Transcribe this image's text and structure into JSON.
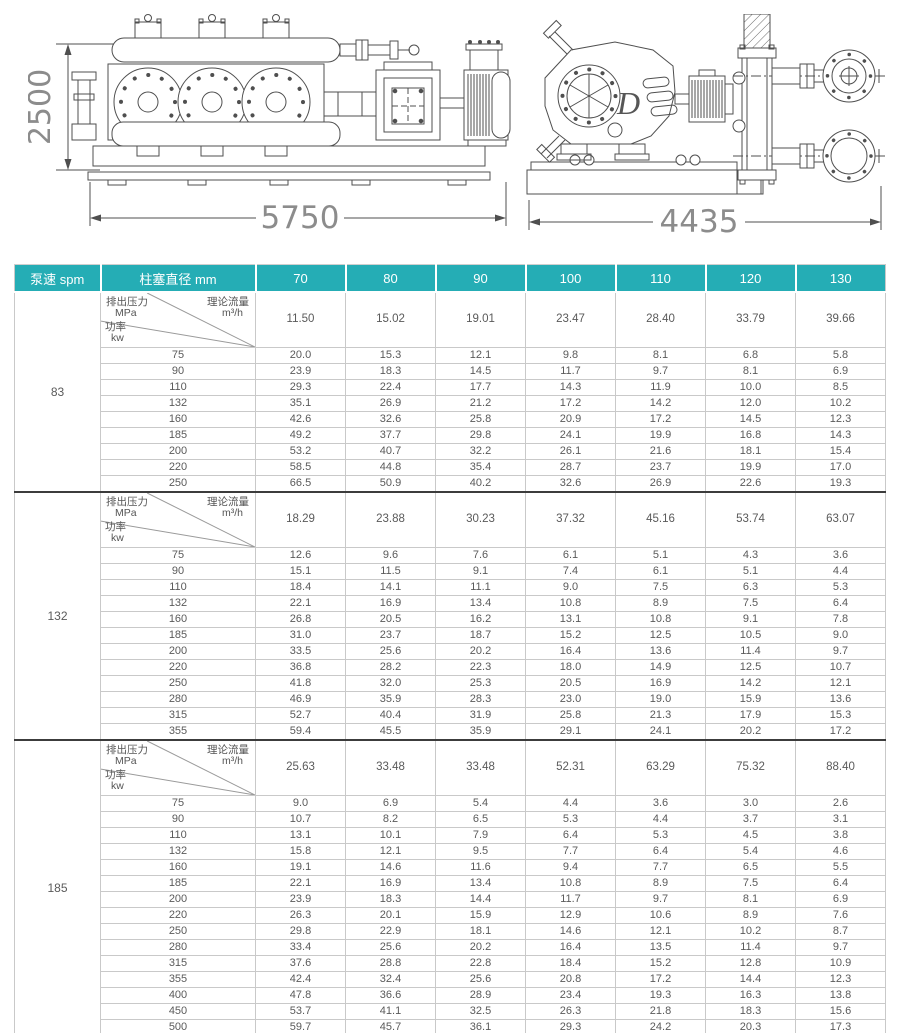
{
  "drawings": {
    "side_view": {
      "height_dim": "2500",
      "length_dim": "5750"
    },
    "end_view": {
      "length_dim": "4435"
    }
  },
  "table": {
    "accent_color": "#25adb5",
    "header": {
      "speed_label": "泵速 spm",
      "diameter_label": "柱塞直径 mm",
      "diameters": [
        "70",
        "80",
        "90",
        "100",
        "110",
        "120",
        "130"
      ]
    },
    "corner": {
      "pressure_label": "排出压力",
      "pressure_unit": "MPa",
      "flow_label": "理论流量",
      "flow_unit": "m³/h",
      "power_label": "功率",
      "power_unit": "kw"
    },
    "sections": [
      {
        "speed": "83",
        "flow": [
          "11.50",
          "15.02",
          "19.01",
          "23.47",
          "28.40",
          "33.79",
          "39.66"
        ],
        "rows": [
          {
            "pressure": "75",
            "values": [
              "20.0",
              "15.3",
              "12.1",
              "9.8",
              "8.1",
              "6.8",
              "5.8"
            ]
          },
          {
            "pressure": "90",
            "values": [
              "23.9",
              "18.3",
              "14.5",
              "11.7",
              "9.7",
              "8.1",
              "6.9"
            ]
          },
          {
            "pressure": "110",
            "values": [
              "29.3",
              "22.4",
              "17.7",
              "14.3",
              "11.9",
              "10.0",
              "8.5"
            ]
          },
          {
            "pressure": "132",
            "values": [
              "35.1",
              "26.9",
              "21.2",
              "17.2",
              "14.2",
              "12.0",
              "10.2"
            ]
          },
          {
            "pressure": "160",
            "values": [
              "42.6",
              "32.6",
              "25.8",
              "20.9",
              "17.2",
              "14.5",
              "12.3"
            ]
          },
          {
            "pressure": "185",
            "values": [
              "49.2",
              "37.7",
              "29.8",
              "24.1",
              "19.9",
              "16.8",
              "14.3"
            ]
          },
          {
            "pressure": "200",
            "values": [
              "53.2",
              "40.7",
              "32.2",
              "26.1",
              "21.6",
              "18.1",
              "15.4"
            ]
          },
          {
            "pressure": "220",
            "values": [
              "58.5",
              "44.8",
              "35.4",
              "28.7",
              "23.7",
              "19.9",
              "17.0"
            ]
          },
          {
            "pressure": "250",
            "values": [
              "66.5",
              "50.9",
              "40.2",
              "32.6",
              "26.9",
              "22.6",
              "19.3"
            ]
          }
        ]
      },
      {
        "speed": "132",
        "flow": [
          "18.29",
          "23.88",
          "30.23",
          "37.32",
          "45.16",
          "53.74",
          "63.07"
        ],
        "rows": [
          {
            "pressure": "75",
            "values": [
              "12.6",
              "9.6",
              "7.6",
              "6.1",
              "5.1",
              "4.3",
              "3.6"
            ]
          },
          {
            "pressure": "90",
            "values": [
              "15.1",
              "11.5",
              "9.1",
              "7.4",
              "6.1",
              "5.1",
              "4.4"
            ]
          },
          {
            "pressure": "110",
            "values": [
              "18.4",
              "14.1",
              "11.1",
              "9.0",
              "7.5",
              "6.3",
              "5.3"
            ]
          },
          {
            "pressure": "132",
            "values": [
              "22.1",
              "16.9",
              "13.4",
              "10.8",
              "8.9",
              "7.5",
              "6.4"
            ]
          },
          {
            "pressure": "160",
            "values": [
              "26.8",
              "20.5",
              "16.2",
              "13.1",
              "10.8",
              "9.1",
              "7.8"
            ]
          },
          {
            "pressure": "185",
            "values": [
              "31.0",
              "23.7",
              "18.7",
              "15.2",
              "12.5",
              "10.5",
              "9.0"
            ]
          },
          {
            "pressure": "200",
            "values": [
              "33.5",
              "25.6",
              "20.2",
              "16.4",
              "13.6",
              "11.4",
              "9.7"
            ]
          },
          {
            "pressure": "220",
            "values": [
              "36.8",
              "28.2",
              "22.3",
              "18.0",
              "14.9",
              "12.5",
              "10.7"
            ]
          },
          {
            "pressure": "250",
            "values": [
              "41.8",
              "32.0",
              "25.3",
              "20.5",
              "16.9",
              "14.2",
              "12.1"
            ]
          },
          {
            "pressure": "280",
            "values": [
              "46.9",
              "35.9",
              "28.3",
              "23.0",
              "19.0",
              "15.9",
              "13.6"
            ]
          },
          {
            "pressure": "315",
            "values": [
              "52.7",
              "40.4",
              "31.9",
              "25.8",
              "21.3",
              "17.9",
              "15.3"
            ]
          },
          {
            "pressure": "355",
            "values": [
              "59.4",
              "45.5",
              "35.9",
              "29.1",
              "24.1",
              "20.2",
              "17.2"
            ]
          }
        ]
      },
      {
        "speed": "185",
        "flow": [
          "25.63",
          "33.48",
          "33.48",
          "52.31",
          "63.29",
          "75.32",
          "88.40"
        ],
        "rows": [
          {
            "pressure": "75",
            "values": [
              "9.0",
              "6.9",
              "5.4",
              "4.4",
              "3.6",
              "3.0",
              "2.6"
            ]
          },
          {
            "pressure": "90",
            "values": [
              "10.7",
              "8.2",
              "6.5",
              "5.3",
              "4.4",
              "3.7",
              "3.1"
            ]
          },
          {
            "pressure": "110",
            "values": [
              "13.1",
              "10.1",
              "7.9",
              "6.4",
              "5.3",
              "4.5",
              "3.8"
            ]
          },
          {
            "pressure": "132",
            "values": [
              "15.8",
              "12.1",
              "9.5",
              "7.7",
              "6.4",
              "5.4",
              "4.6"
            ]
          },
          {
            "pressure": "160",
            "values": [
              "19.1",
              "14.6",
              "11.6",
              "9.4",
              "7.7",
              "6.5",
              "5.5"
            ]
          },
          {
            "pressure": "185",
            "values": [
              "22.1",
              "16.9",
              "13.4",
              "10.8",
              "8.9",
              "7.5",
              "6.4"
            ]
          },
          {
            "pressure": "200",
            "values": [
              "23.9",
              "18.3",
              "14.4",
              "11.7",
              "9.7",
              "8.1",
              "6.9"
            ]
          },
          {
            "pressure": "220",
            "values": [
              "26.3",
              "20.1",
              "15.9",
              "12.9",
              "10.6",
              "8.9",
              "7.6"
            ]
          },
          {
            "pressure": "250",
            "values": [
              "29.8",
              "22.9",
              "18.1",
              "14.6",
              "12.1",
              "10.2",
              "8.7"
            ]
          },
          {
            "pressure": "280",
            "values": [
              "33.4",
              "25.6",
              "20.2",
              "16.4",
              "13.5",
              "11.4",
              "9.7"
            ]
          },
          {
            "pressure": "315",
            "values": [
              "37.6",
              "28.8",
              "22.8",
              "18.4",
              "15.2",
              "12.8",
              "10.9"
            ]
          },
          {
            "pressure": "355",
            "values": [
              "42.4",
              "32.4",
              "25.6",
              "20.8",
              "17.2",
              "14.4",
              "12.3"
            ]
          },
          {
            "pressure": "400",
            "values": [
              "47.8",
              "36.6",
              "28.9",
              "23.4",
              "19.3",
              "16.3",
              "13.8"
            ]
          },
          {
            "pressure": "450",
            "values": [
              "53.7",
              "41.1",
              "32.5",
              "26.3",
              "21.8",
              "18.3",
              "15.6"
            ]
          },
          {
            "pressure": "500",
            "values": [
              "59.7",
              "45.7",
              "36.1",
              "29.3",
              "24.2",
              "20.3",
              "17.3"
            ]
          }
        ]
      }
    ]
  }
}
